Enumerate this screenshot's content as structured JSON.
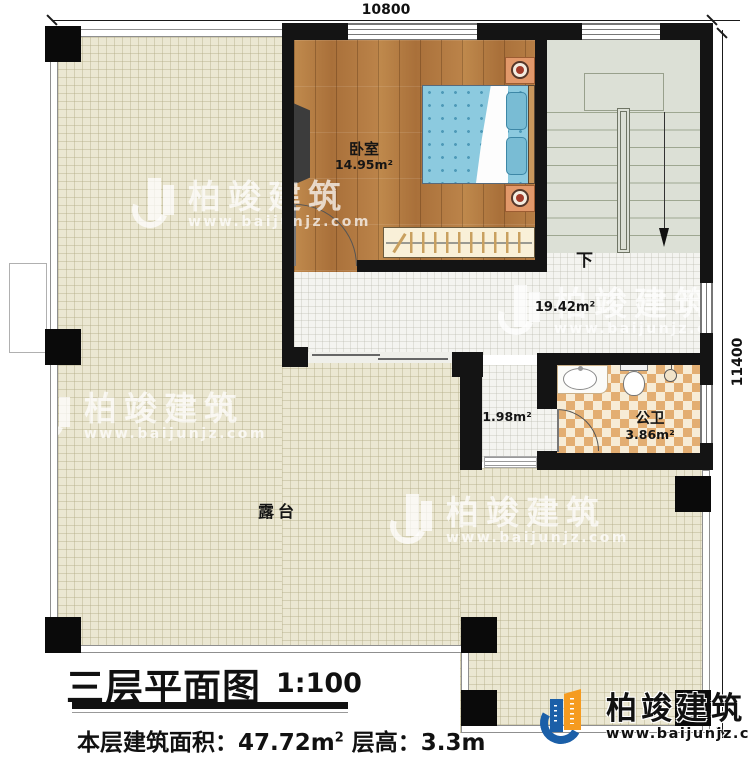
{
  "dimensions": {
    "top": "10800",
    "right": "11400"
  },
  "rooms": {
    "bedroom": {
      "name": "卧室",
      "area": "14.95m²"
    },
    "hall": {
      "area": "19.42m²",
      "down_label": "下"
    },
    "corridor": {
      "area": "1.98m²"
    },
    "bathroom": {
      "name": "公卫",
      "area": "3.86m²"
    },
    "terrace": {
      "name": "露台"
    }
  },
  "title_block": {
    "title": "三层平面图",
    "scale": "1:100",
    "info_prefix": "本层建筑面积：47.72m",
    "info_sup": "2",
    "info_suffix": " 层高：3.3m"
  },
  "brand": {
    "name": "柏竣建筑",
    "url": "www.baijunjz.com"
  },
  "colors": {
    "wall": "#141414",
    "terrace_tile": "#ebe7d2",
    "wood_floor": "#b1793f",
    "stair_floor": "#dce0d6",
    "bath_tile": "#e3ae72",
    "bed_blue": "#8ccadf",
    "brand_blue": "#1b5fa8",
    "brand_orange": "#f59b20"
  }
}
